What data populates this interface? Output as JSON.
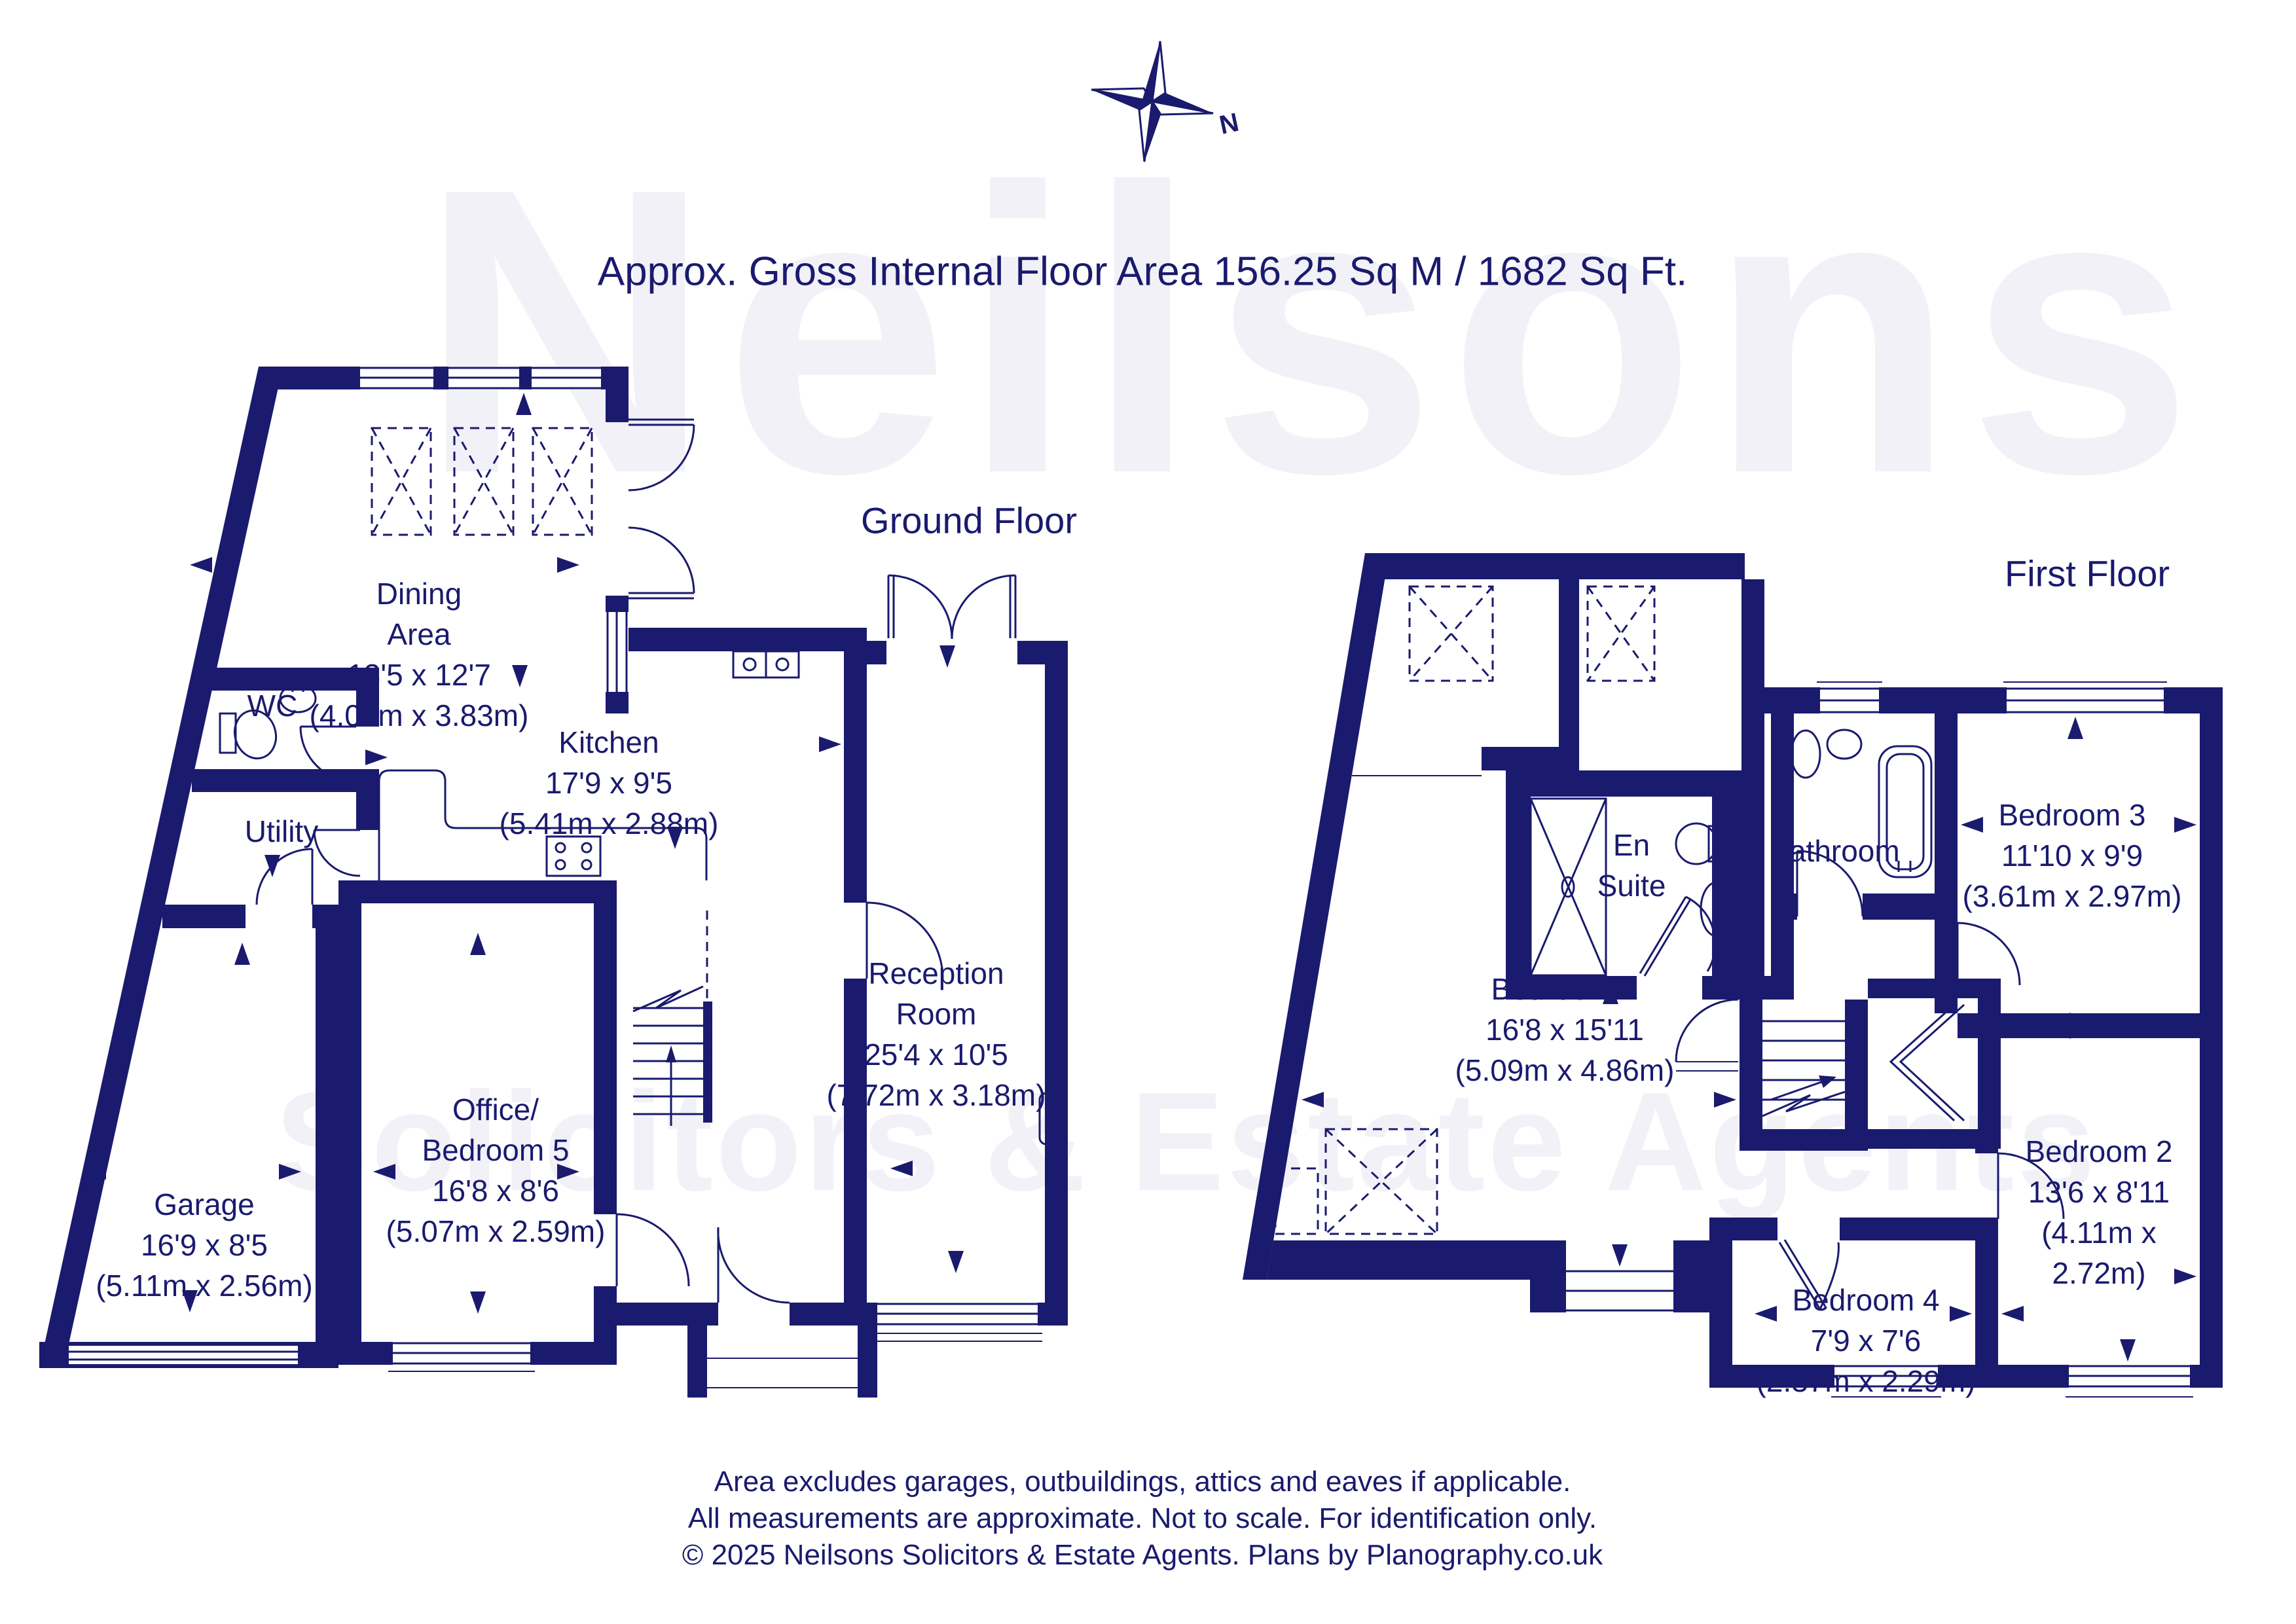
{
  "title": "Approx. Gross Internal Floor Area 156.25 Sq M / 1682 Sq Ft.",
  "compass": {
    "north_label": "N"
  },
  "watermark": {
    "line1": "Neilsons",
    "line2": "Solicitors & Estate Agents"
  },
  "colors": {
    "ink": "#1a1a6e",
    "watermark": "#f1f1f7",
    "background": "#ffffff"
  },
  "floors": [
    {
      "title": "Ground Floor",
      "rooms": [
        {
          "name": "Dining\nArea",
          "imperial": "13'5 x 12'7",
          "metric": "(4.08m x 3.83m)"
        },
        {
          "name": "WC",
          "imperial": "",
          "metric": ""
        },
        {
          "name": "Utility",
          "imperial": "",
          "metric": ""
        },
        {
          "name": "Kitchen",
          "imperial": "17'9 x 9'5",
          "metric": "(5.41m x 2.88m)"
        },
        {
          "name": "Office/\nBedroom 5",
          "imperial": "16'8 x 8'6",
          "metric": "(5.07m x 2.59m)"
        },
        {
          "name": "Garage",
          "imperial": "16'9 x 8'5",
          "metric": "(5.11m x 2.56m)"
        },
        {
          "name": "Reception\nRoom",
          "imperial": "25'4 x 10'5",
          "metric": "(7.72m x 3.18m)"
        }
      ]
    },
    {
      "title": "First Floor",
      "rooms": [
        {
          "name": "Bedroom 1",
          "imperial": "16'8 x 15'11",
          "metric": "(5.09m x 4.86m)"
        },
        {
          "name": "En\nSuite",
          "imperial": "",
          "metric": ""
        },
        {
          "name": "Bathroom",
          "imperial": "",
          "metric": ""
        },
        {
          "name": "Bedroom 3",
          "imperial": "11'10 x 9'9",
          "metric": "(3.61m x 2.97m)"
        },
        {
          "name": "Bedroom 4",
          "imperial": "7'9 x 7'6",
          "metric": "(2.37m x 2.29m)"
        },
        {
          "name": "Bedroom 2",
          "imperial": "13'6 x 8'11",
          "metric": "(4.11m x 2.72m)"
        }
      ]
    }
  ],
  "footer": {
    "line1": "Area excludes garages, outbuildings, attics and eaves if applicable.",
    "line2": "All measurements are approximate. Not to scale. For identification only.",
    "line3": "© 2025 Neilsons Solicitors & Estate Agents. Plans by Planography.co.uk"
  }
}
